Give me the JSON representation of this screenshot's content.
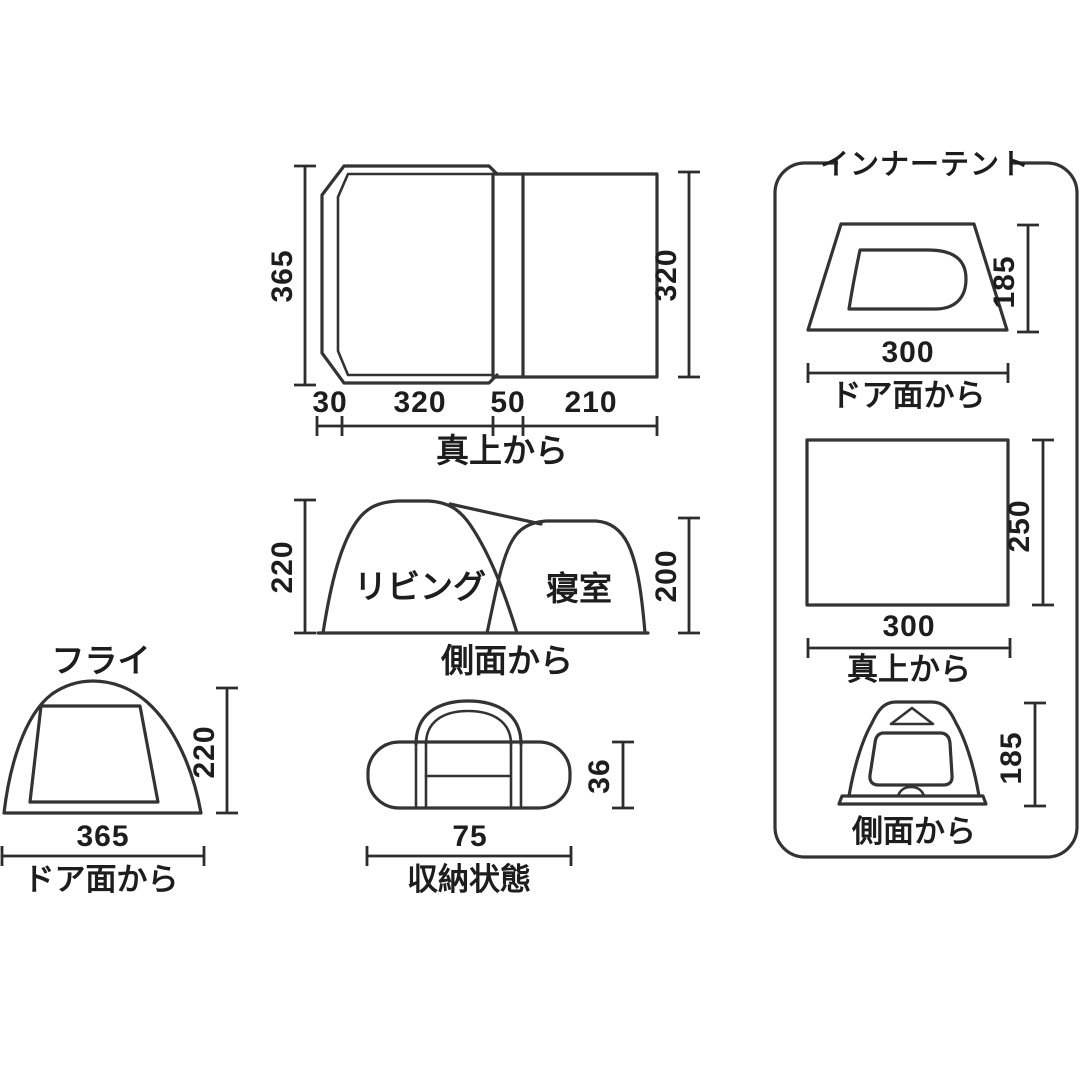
{
  "page": {
    "background": "#ffffff",
    "line_color": "#333333",
    "text_color": "#1d1d1d"
  },
  "fly_top_view": {
    "label": "真上から",
    "dim_left": "365",
    "dim_right": "320",
    "dims_bottom": [
      "30",
      "320",
      "50",
      "210"
    ]
  },
  "side_view": {
    "label": "側面から",
    "dim_left": "220",
    "dim_right": "200",
    "room_living": "リビング",
    "room_bedroom": "寝室"
  },
  "fly_front_view": {
    "title": "フライ",
    "label": "ドア面から",
    "dim_height": "220",
    "dim_width": "365"
  },
  "packed_view": {
    "label": "収納状態",
    "dim_height": "36",
    "dim_width": "75"
  },
  "inner_tent": {
    "title": "インナーテント",
    "door_view": {
      "label": "ドア面から",
      "dim_height": "185",
      "dim_width": "300"
    },
    "top_view": {
      "label": "真上から",
      "dim_height": "250",
      "dim_width": "300"
    },
    "side_view": {
      "label": "側面から",
      "dim_height": "185"
    }
  }
}
